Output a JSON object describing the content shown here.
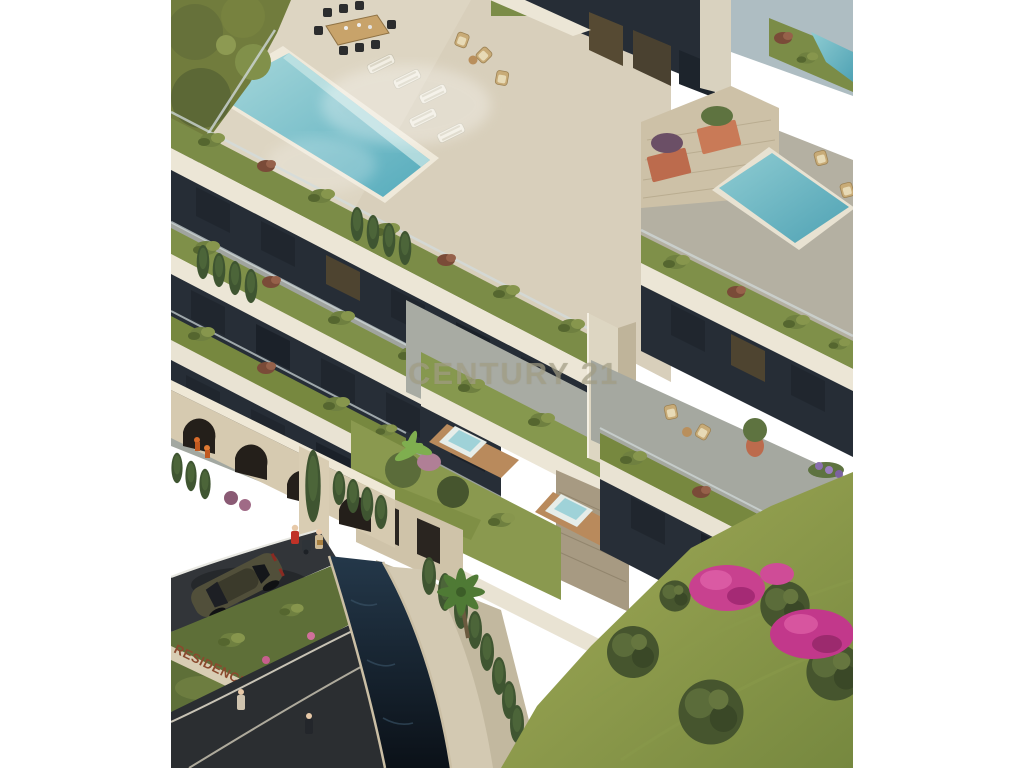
{
  "image": {
    "kind": "3d-architectural-render",
    "description": "Aerial isometric render of a terraced luxury residence with rooftop infinity pools, green roofs, stone arcade entrance, curving entry road, water canal and flowering gardens",
    "watermark": {
      "text": "CENTURY 21",
      "color": "#a7a288"
    },
    "entrance_sign": {
      "text": "RESIDENCE",
      "color": "#8a4a2e"
    },
    "scene": {
      "features": [
        "rooftop infinity pool",
        "outdoor dining table with eight chairs",
        "white sun loungers",
        "wicker lounge chairs",
        "second rooftop pool with terracotta planters",
        "stepped terraces with planted green roofs",
        "glass balustrades",
        "central travertine chimney column",
        "two plunge jacuzzis with wood decks",
        "stone arcade entrance wall",
        "entry road with dark bronze sports coupe",
        "dark water canal with stone walkway",
        "palm tree and cypress hedges",
        "hillside lawn with olive trees",
        "magenta bougainvillea in bloom"
      ],
      "people": [
        "person in red jacket pushing stroller",
        "companion carrying a box",
        "two pedestrians on lower path",
        "climbers inside an arch"
      ],
      "vehicle": "dark bronze sports coupe"
    },
    "palette": {
      "deck_cream": "#ddd5c2",
      "fascia": "#ece6d6",
      "stone": "#cdc1a7",
      "dark_wall": "#262d36",
      "glass_amber": "#564a33",
      "pool_water": "#74bfca",
      "canal_water": "#15212e",
      "roof_green": "#7b8c47",
      "hedge_green": "#3f5531",
      "lawn": "#96a052",
      "terracotta": "#bc6b4d",
      "road": "#323539",
      "bougainvillea": "#c8418f",
      "car": "#514f3a"
    }
  }
}
